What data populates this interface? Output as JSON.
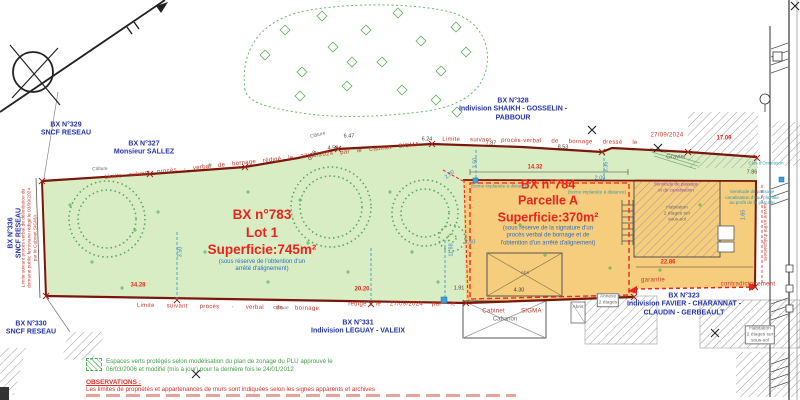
{
  "plan": {
    "parcel_lot1": {
      "id": "BX n°783",
      "lot": "Lot 1",
      "area": "Superficie:745m²",
      "note1": "(sous réserve de l'obtention d'un",
      "note2": "arrêté d'alignement)"
    },
    "parcel_a": {
      "id": "BX n°784",
      "lot": "Parcelle A",
      "area": "Superficie:370m²",
      "note1": "(sous réserve de la signature d'un",
      "note2": "procès verbal de bornage et de",
      "note3": "l'obtention d'un arrêté d'alignement)"
    },
    "neighbors": [
      {
        "id": "n329",
        "lines": [
          "BX N°329",
          "SNCF RESEAU"
        ],
        "x": 66,
        "y": 130
      },
      {
        "id": "n327",
        "lines": [
          "BX N°327",
          "Monsieur SALLEZ"
        ],
        "x": 144,
        "y": 149
      },
      {
        "id": "n328",
        "lines": [
          "BX N°328",
          "Indivision SHAIKH - GOSSELIN -",
          "PABBOUR"
        ],
        "x": 513,
        "y": 110
      },
      {
        "id": "n336",
        "lines": [
          "BX N°336",
          "SNCF RESEAU"
        ],
        "x": 16,
        "y": 233,
        "rot": -90
      },
      {
        "id": "n330",
        "lines": [
          "BX N°330",
          "SNCF RESEAU"
        ],
        "x": 31,
        "y": 329
      },
      {
        "id": "n331",
        "lines": [
          "BX N°331",
          "Indivision LEGUAY - VALEIX"
        ],
        "x": 358,
        "y": 328
      },
      {
        "id": "n323",
        "lines": [
          "BX N°323",
          "Indivision FAVIER - CHARANNAT -",
          "CLAUDIN - GERBEAULT"
        ],
        "x": 684,
        "y": 305
      }
    ],
    "boundary_notes": [
      {
        "t": "Limite suivant procès - verbal de bornage rédigé le 27/09/2024 par le Cabinet SIGMA",
        "x": 262,
        "y": 162,
        "rot": -6,
        "ws": 5,
        "cls": "c-btxt"
      },
      {
        "t": "Limite suivant procès-verbal de bornage dressé le",
        "x": 540,
        "y": 142,
        "rot": 1,
        "ws": 8,
        "cls": "c-btxt"
      },
      {
        "t": "27/09/2024",
        "x": 667,
        "y": 136,
        "cls": "c-btxt"
      },
      {
        "t": "Limite suivant procès - verbal de bornage",
        "x": 228,
        "y": 308,
        "rot": 1,
        "ws": 10,
        "cls": "c-btxt"
      },
      {
        "t": "rédigé le 27/09/2024 par le",
        "x": 402,
        "y": 305,
        "ws": 7,
        "cls": "c-btxt"
      },
      {
        "t": "Cabinet SIGMA",
        "x": 512,
        "y": 312,
        "ws": 14,
        "cls": "c-btxt"
      },
      {
        "lines": [
          "Limite suivant procès verbal de délimitation du",
          "domaine public ferroviaire rédigé le 03/09/2024",
          "par le Cabinet SIGMA"
        ],
        "x": 30,
        "y": 238,
        "rot": -90,
        "cls": "c-btxt-sm"
      },
      {
        "t": "suivant arrêté d'alignement",
        "x": 764,
        "y": 232,
        "rot": 90,
        "cls": "c-btxt-sm"
      },
      {
        "t": "garantie",
        "x": 653,
        "y": 281,
        "cls": "c-btxt"
      },
      {
        "t": "contradictoirement",
        "x": 748,
        "y": 285,
        "cls": "c-btxt"
      }
    ],
    "features": [
      {
        "t": "Gravier",
        "x": 676,
        "y": 158,
        "cls": "c-feat"
      },
      {
        "lines": [
          "Habitation",
          "2 étages sur",
          "sous-sol"
        ],
        "x": 677,
        "y": 214,
        "cls": "c-feat c-tiny"
      },
      {
        "t": "Cabanon",
        "x": 505,
        "y": 320,
        "cls": "c-feat"
      },
      {
        "t": "Abri",
        "x": 525,
        "y": 274,
        "cls": "c-feat c-tiny"
      },
      {
        "t": "Abris",
        "x": 578,
        "y": 308,
        "cls": "c-feat c-tiny"
      },
      {
        "lines": [
          "Annexe",
          "2 étages"
        ],
        "x": 608,
        "y": 300,
        "cls": "c-feat c-tiny c-box"
      },
      {
        "lines": [
          "Habitation",
          "2 étages sur",
          "sous-sol"
        ],
        "x": 760,
        "y": 335,
        "cls": "c-feat c-tiny c-box"
      },
      {
        "t": "Clos d'Ormesson",
        "x": 766,
        "y": 163,
        "cls": "c-teal"
      },
      {
        "lines": [
          "Servitude de passage",
          "canalisation d'eau pluviale",
          "au profit de la parcelle"
        ],
        "x": 752,
        "y": 197,
        "cls": "c-teal"
      },
      {
        "lines": [
          "Servitude de passage",
          "et de canalisation"
        ],
        "x": 676,
        "y": 187,
        "cls": "c-violet"
      },
      {
        "t": "(borne implantée à distance)",
        "x": 500,
        "y": 186,
        "cls": "c-teal"
      },
      {
        "t": "(borne implantée à distance)",
        "x": 597,
        "y": 192,
        "cls": "c-teal"
      },
      {
        "t": "Clôture",
        "x": 100,
        "y": 170,
        "rot": -3,
        "cls": "c-feat c-tiny"
      },
      {
        "t": "Clôture",
        "x": 318,
        "y": 136,
        "rot": -14,
        "cls": "c-feat c-tiny"
      },
      {
        "t": "Clôture",
        "x": 281,
        "y": 309,
        "cls": "c-feat c-tiny"
      }
    ],
    "measurements": [
      {
        "v": "34.28",
        "x": 138,
        "y": 286,
        "cls": "c-red-m"
      },
      {
        "v": "20.20",
        "x": 362,
        "y": 290,
        "cls": "c-red-m"
      },
      {
        "v": "14.32",
        "x": 535,
        "y": 168,
        "cls": "c-red-m"
      },
      {
        "v": "22.86",
        "x": 668,
        "y": 263,
        "cls": "c-red-m"
      },
      {
        "v": "17.09",
        "x": 724,
        "y": 139,
        "cls": "c-red-m"
      },
      {
        "v": "6.47",
        "x": 349,
        "y": 137,
        "cls": "c-dark-m"
      },
      {
        "v": "6.24",
        "x": 427,
        "y": 140,
        "cls": "c-dark-m"
      },
      {
        "v": "7.87",
        "x": 491,
        "y": 144,
        "cls": "c-dark-m"
      },
      {
        "v": "8.53",
        "x": 563,
        "y": 148,
        "cls": "c-dark-m"
      },
      {
        "v": "7.86",
        "x": 752,
        "y": 173,
        "cls": "c-dark-m"
      },
      {
        "v": "1.91",
        "x": 459,
        "y": 289,
        "cls": "c-dark-m"
      },
      {
        "v": "4.30",
        "x": 519,
        "y": 291,
        "cls": "c-dark-m"
      },
      {
        "v": "4.50",
        "x": 333,
        "y": 149,
        "cls": "c-dark-m"
      },
      {
        "v": "0.58",
        "x": 313,
        "y": 156,
        "rot": -55,
        "cls": "c-dark-m"
      },
      {
        "v": "2.60",
        "x": 470,
        "y": 243,
        "cls": "c-blue-m"
      },
      {
        "v": "2.09",
        "x": 600,
        "y": 179,
        "cls": "c-blue-m"
      },
      {
        "v": "3.50",
        "x": 476,
        "y": 163,
        "rot": -90,
        "cls": "c-blue-m"
      },
      {
        "v": "3.50",
        "x": 181,
        "y": 252,
        "rot": -90,
        "cls": "c-blue-m"
      },
      {
        "v": "3.35",
        "x": 607,
        "y": 167,
        "rot": -90,
        "cls": "c-blue-m"
      },
      {
        "v": "11.88",
        "x": 452,
        "y": 250,
        "rot": -90,
        "cls": "c-blue-m"
      },
      {
        "v": "1.65",
        "x": 744,
        "y": 215,
        "rot": -90,
        "cls": "c-blue-m"
      },
      {
        "v": "2.00",
        "x": 450,
        "y": 175,
        "rot": -40,
        "cls": "c-blue-m"
      }
    ],
    "legend": {
      "line1": "Espaces verts protégés selon modélisation du plan de zonage du PLU approuvé le",
      "line2": "06/03/2006 et modifié (mis à jour) pour la dernière fois le 24/01/2012"
    },
    "observations": {
      "heading": "OBSERVATIONS :",
      "line1": "Les limites de propriétés et appartenances de murs sont indiquées selon les signes apparents et archives"
    }
  },
  "colors": {
    "parcel_green": "#d9edc4",
    "parcel_orange": "#f6cc7d",
    "boundary_dark_red": "#7a160c",
    "limit_red": "#e8241f",
    "owner_blue": "#2433a8",
    "note_blue": "#2f6fbe",
    "legend_green": "#43a047",
    "observation_red": "#d93025"
  }
}
